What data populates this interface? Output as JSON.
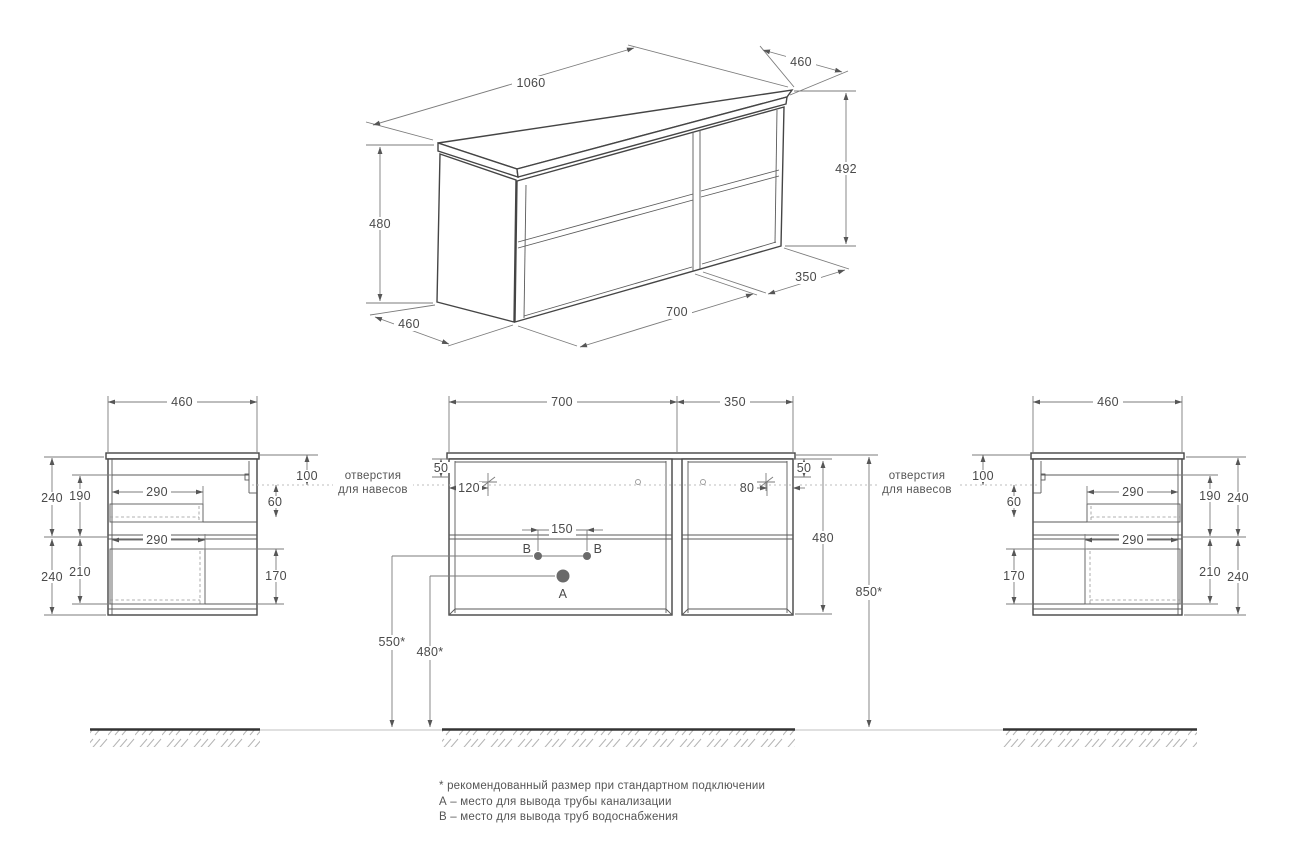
{
  "iso": {
    "dim_top_width": "1060",
    "dim_top_depth": "460",
    "dim_right_height": "492",
    "dim_left_height": "480",
    "dim_bottom_depth": "460",
    "dim_front_width": "700",
    "dim_right_width": "350"
  },
  "left_view": {
    "dim_width": "460",
    "dim_outer_top": "240",
    "dim_inner_top": "190",
    "dim_drawer_top": "290",
    "dim_drawer_bottom": "290",
    "dim_outer_bottom": "240",
    "dim_inner_bottom": "210",
    "dim_hanger_offset": "100",
    "dim_hanger_gap": "60",
    "dim_drawer_depth": "170",
    "hanger_note_line1": "отверстия",
    "hanger_note_line2": "для навесов"
  },
  "front_view": {
    "dim_width_left": "700",
    "dim_width_right": "350",
    "dim_top_rail_left": "50",
    "dim_top_rail_right": "50",
    "dim_hole_left": "120",
    "dim_hole_right": "80",
    "dim_height": "480",
    "dim_mount_height": "850*",
    "dim_b_spacing": "150",
    "dim_b_height": "550*",
    "dim_a_height": "480*",
    "label_a": "А",
    "label_b_left": "В",
    "label_b_right": "В"
  },
  "right_view": {
    "dim_width": "460",
    "dim_hanger_offset": "100",
    "dim_hanger_gap": "60",
    "dim_drawer_depth": "170",
    "dim_drawer_top": "290",
    "dim_drawer_bottom": "290",
    "dim_inner_top": "190",
    "dim_outer_top": "240",
    "dim_inner_bottom": "210",
    "dim_outer_bottom": "240",
    "hanger_note_line1": "отверстия",
    "hanger_note_line2": "для навесов"
  },
  "footnotes": {
    "line1": "* рекомендованный размер при стандартном подключении",
    "line2": "А – место для вывода трубы канализации",
    "line3": "В – место для вывода труб водоснабжения"
  }
}
